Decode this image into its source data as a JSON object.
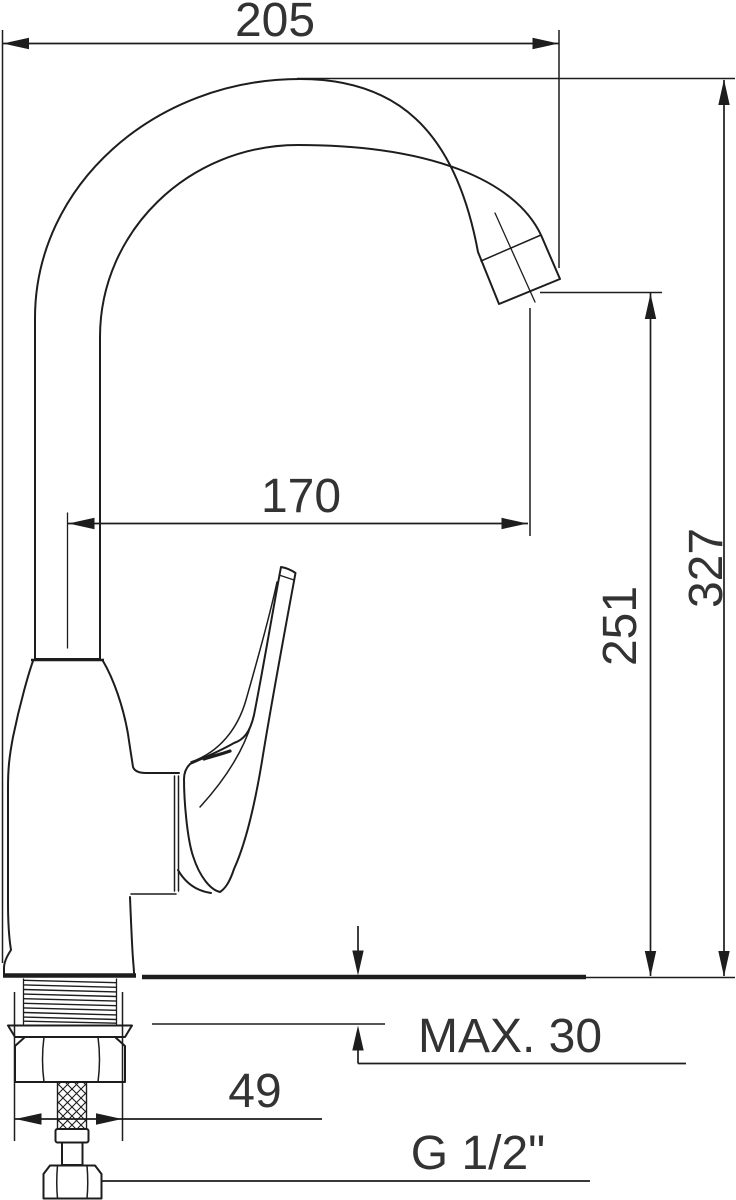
{
  "drawing": {
    "title": "faucet-dimension-drawing",
    "labels": {
      "spout_width": "205",
      "spout_reach": "170",
      "outlet_height": "251",
      "total_height": "327",
      "base_width": "49",
      "max_mounting_thickness": "MAX. 30",
      "connection_thread": "G 1/2\""
    },
    "colors": {
      "background": "#ffffff",
      "line": "#1d1d1d",
      "text": "#333333"
    }
  }
}
